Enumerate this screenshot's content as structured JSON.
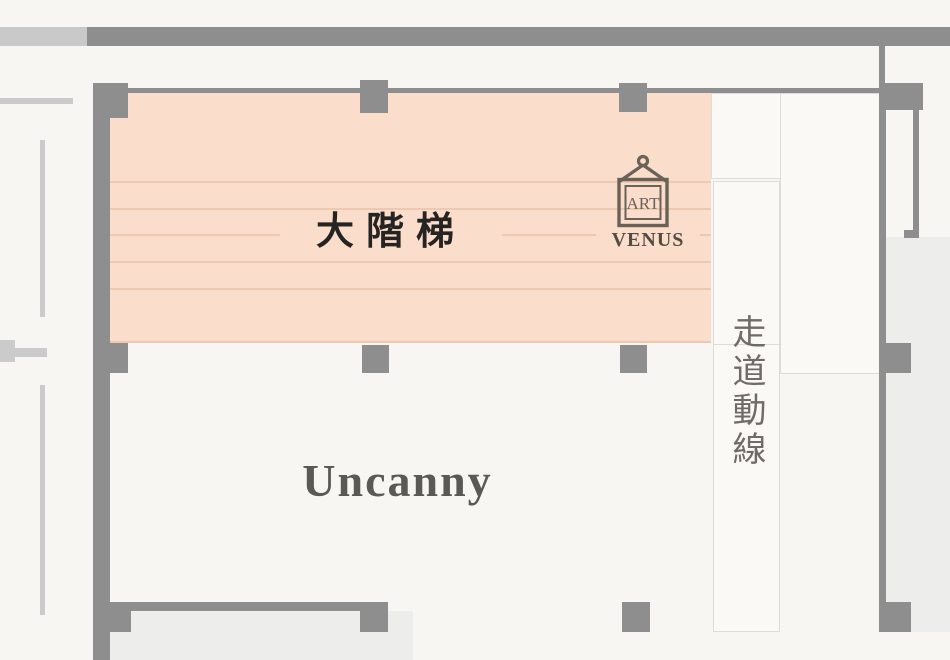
{
  "plan": {
    "stair_zone": {
      "label": "大階梯"
    },
    "artwork": {
      "frame_label": "ART",
      "name": "VENUS"
    },
    "corridor": {
      "label": "走道動線"
    },
    "room": {
      "label": "Uncanny"
    }
  },
  "colors": {
    "background": "#f7f6f3",
    "stair_fill": "#fbddcb",
    "stair_line": "#eec9b1",
    "wall_dark": "#8e8e8e",
    "wall_light": "#c9c9c9",
    "line_light": "#cbcbcb",
    "box_border": "#dedcd8",
    "box_fill": "#faf9f6",
    "area_fill": "#ededeb",
    "text_dark": "#262422",
    "text_gray": "#5b5956",
    "text_corridor": "#6f6c68",
    "artwork": "#6a6157"
  }
}
